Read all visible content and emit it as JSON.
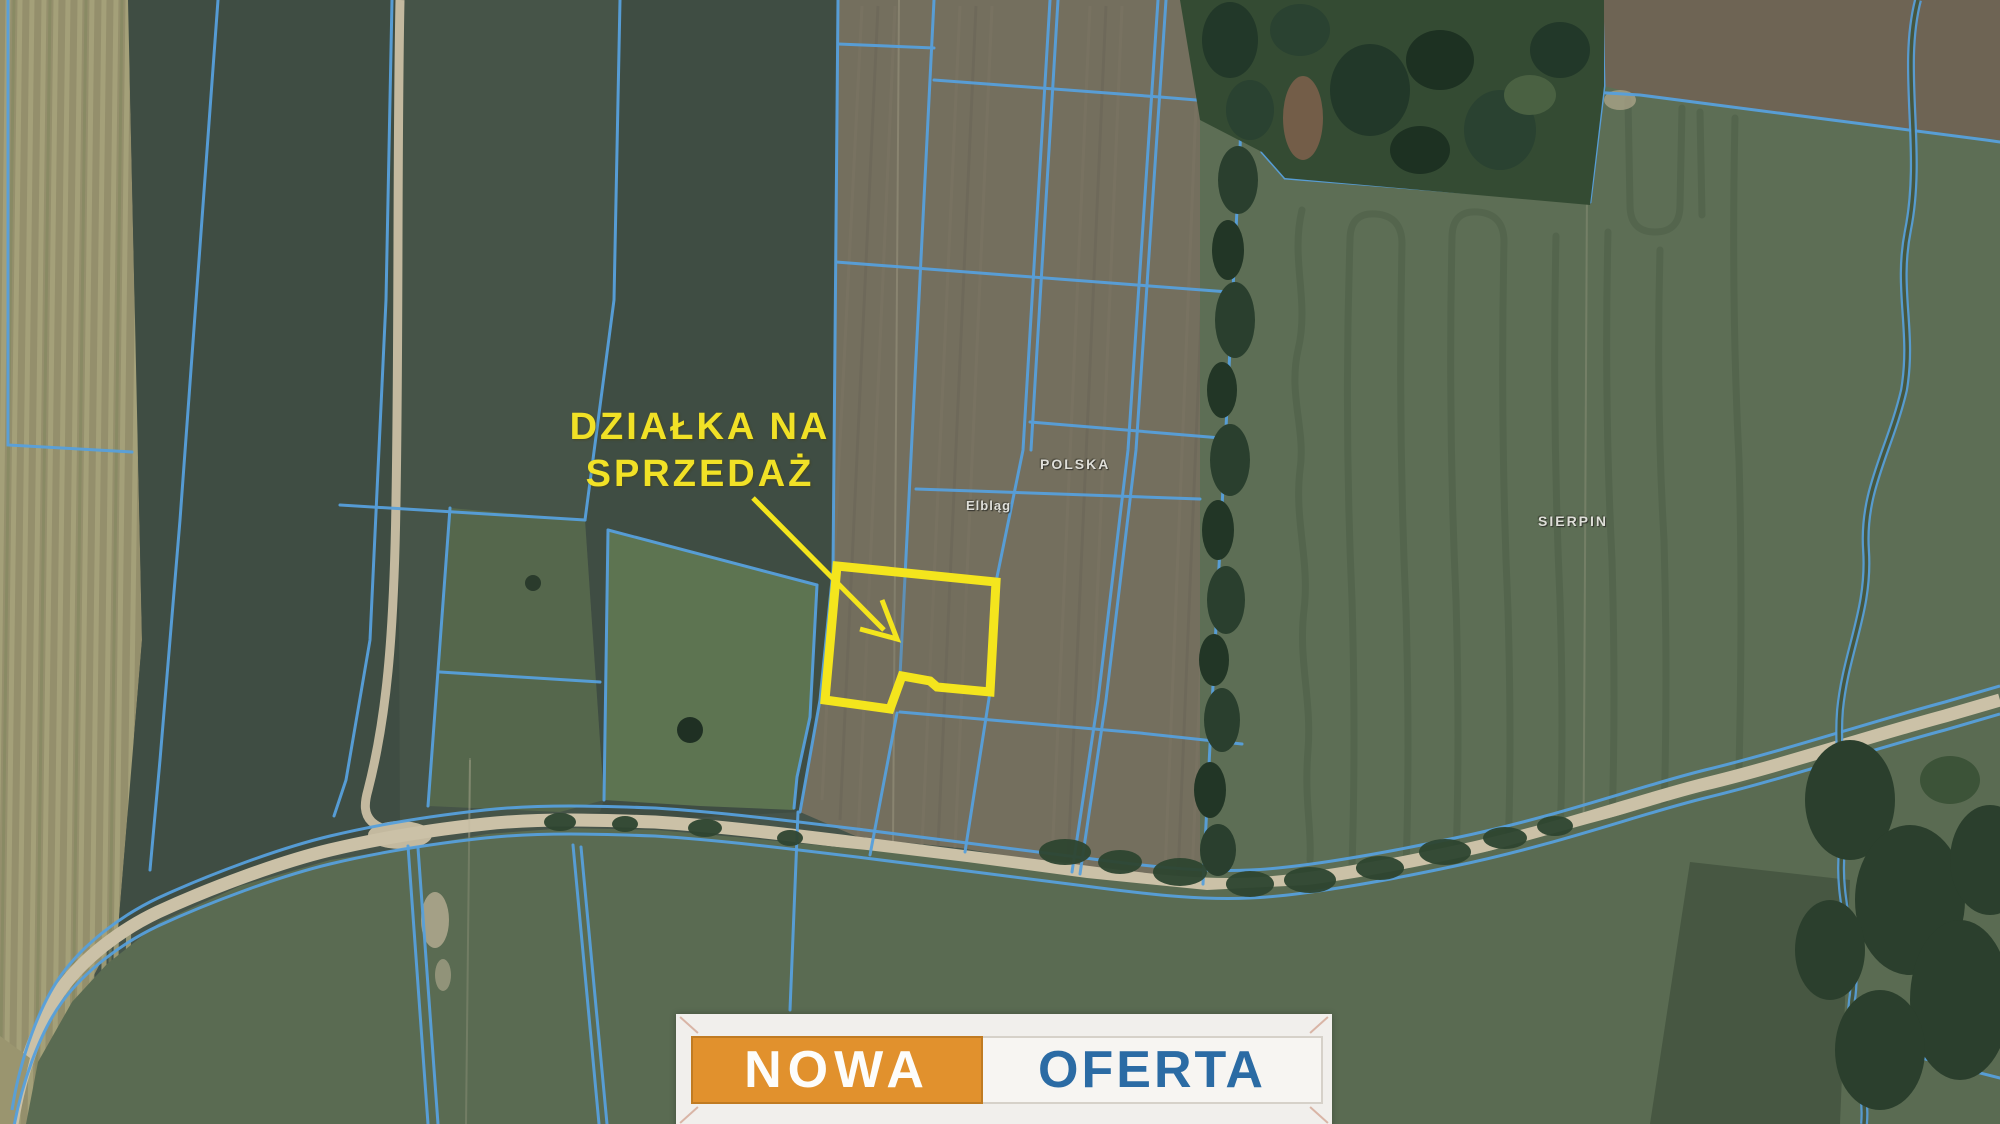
{
  "map": {
    "callout": {
      "line1": "DZIAŁKA NA",
      "line2": "SPRZEDAŻ"
    },
    "place_labels": [
      {
        "text": "POLSKA"
      },
      {
        "text": "Elbląg"
      },
      {
        "text": "SIERPIN"
      }
    ]
  },
  "banner": {
    "left_word": "NOWA",
    "right_word": "OFERTA"
  },
  "colors": {
    "highlight_yellow": "#f4e51d",
    "cadastral_blue": "#57a0dc",
    "banner_orange": "#e1912d",
    "banner_blue": "#2b6ba4",
    "road_tan": "#cbc1a7",
    "field_dark_green": "#3f4d43",
    "field_light_green": "#5d6e55",
    "field_brown": "#746f5e"
  }
}
